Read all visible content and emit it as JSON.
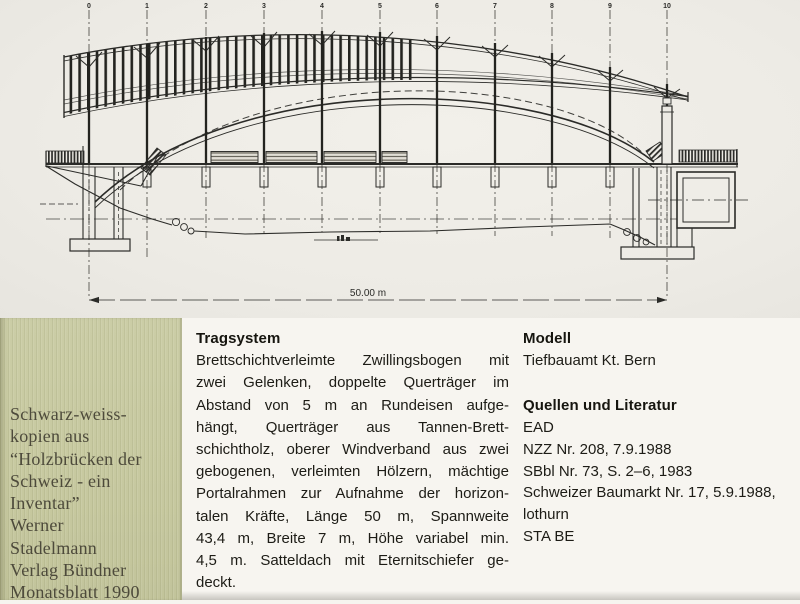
{
  "drawing": {
    "description": "Side elevation of a timber arch bridge (Holzbruecke), twin glulam arch with hangers, roofed deck, 11 grid axes",
    "grid_labels": [
      "0",
      "1",
      "2",
      "3",
      "4",
      "5",
      "6",
      "7",
      "8",
      "9",
      "10"
    ],
    "dimension_label": "50.00 m"
  },
  "sidebar": {
    "lines": [
      "Schwarz-weiss-",
      "kopien aus",
      "“Holzbrücken der",
      "Schweiz - ein",
      "Inventar”",
      "Werner",
      "Stadelmann",
      "Verlag Bündner",
      "Monatsblatt 1990"
    ]
  },
  "sections": {
    "tragsystem": {
      "heading": "Tragsystem",
      "lines": [
        "Brettschichtverleimte Zwillingsbogen mit",
        "zwei Gelenken, doppelte Querträger im",
        "Abstand von 5 m an Rundeisen aufge-",
        "hängt, Querträger aus Tannen-Brett-",
        "schichtholz, oberer Windverband aus zwei",
        "gebogenen, verleimten Hölzern, mächtige",
        "Portalrahmen zur Aufnahme der horizon-",
        "talen Kräfte, Länge 50 m, Spannweite",
        "43,4 m, Breite 7 m, Höhe variabel min.",
        "4,5 m. Satteldach mit Eternitschiefer ge-",
        "deckt."
      ]
    },
    "modell": {
      "heading": "Modell",
      "body": "Tiefbauamt Kt. Bern"
    },
    "quellen": {
      "heading": "Quellen und Literatur",
      "items": [
        "EAD",
        "NZZ Nr. 208, 7.9.1988",
        "SBbl Nr. 73, S. 2–6, 1983",
        "Schweizer Baumarkt Nr. 17, 5.9.1988,",
        "lothurn",
        "STA BE"
      ]
    }
  },
  "colors": {
    "paper_drawing": "#edebe5",
    "paper_text": "#f7f5f0",
    "sidebar_green": "#c7c9a0",
    "ink": "#2b2b28",
    "sidebar_text": "#4d4a3b"
  }
}
